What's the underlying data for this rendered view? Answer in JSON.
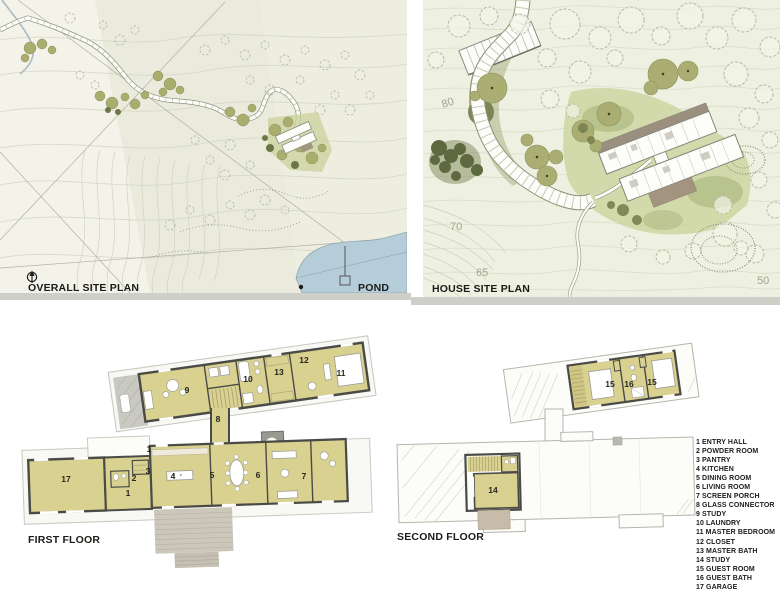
{
  "overall_site_plan": {
    "title": "OVERALL SITE PLAN",
    "pond_label": "POND",
    "colors": {
      "background": "#edeee0",
      "pond": "#b5cdd8",
      "tree": "#a9ad6e",
      "shrub": "#6b7647",
      "contour": "#d5d7c5"
    }
  },
  "house_site_plan": {
    "title": "HOUSE SITE PLAN",
    "contours": {
      "c80": "80",
      "c70": "70",
      "c65": "65",
      "c50": "50"
    },
    "colors": {
      "background": "#eef0e1",
      "lawn": "#cbd49e",
      "tree": "#abae72",
      "conifer": "#5e693f",
      "roof": "#9b9080"
    }
  },
  "first_floor": {
    "title": "FIRST FLOOR",
    "rooms": {
      "r1a": "1",
      "r1b": "1",
      "r2": "2",
      "r3": "3",
      "r4": "4",
      "r5": "5",
      "r6": "6",
      "r7": "7",
      "r8": "8",
      "r9": "9",
      "r10": "10",
      "r11": "11",
      "r12": "12",
      "r13": "13",
      "r17": "17"
    },
    "colors": {
      "room_fill": "#d9d190",
      "wall": "#4a4a46",
      "deck": "#cbc7ba"
    }
  },
  "second_floor": {
    "title": "SECOND FLOOR",
    "rooms": {
      "r14": "14",
      "r15a": "15",
      "r15b": "15",
      "r16": "16"
    }
  },
  "legend": {
    "items": [
      "1 ENTRY HALL",
      "2 POWDER ROOM",
      "3 PANTRY",
      "4 KITCHEN",
      "5 DINING ROOM",
      "6 LIVING ROOM",
      "7 SCREEN PORCH",
      "8 GLASS CONNECTOR",
      "9 STUDY",
      "10 LAUNDRY",
      "11 MASTER BEDROOM",
      "12 CLOSET",
      "13 MASTER BATH",
      "14 STUDY",
      "15 GUEST ROOM",
      "16 GUEST BATH",
      "17 GARAGE"
    ]
  }
}
